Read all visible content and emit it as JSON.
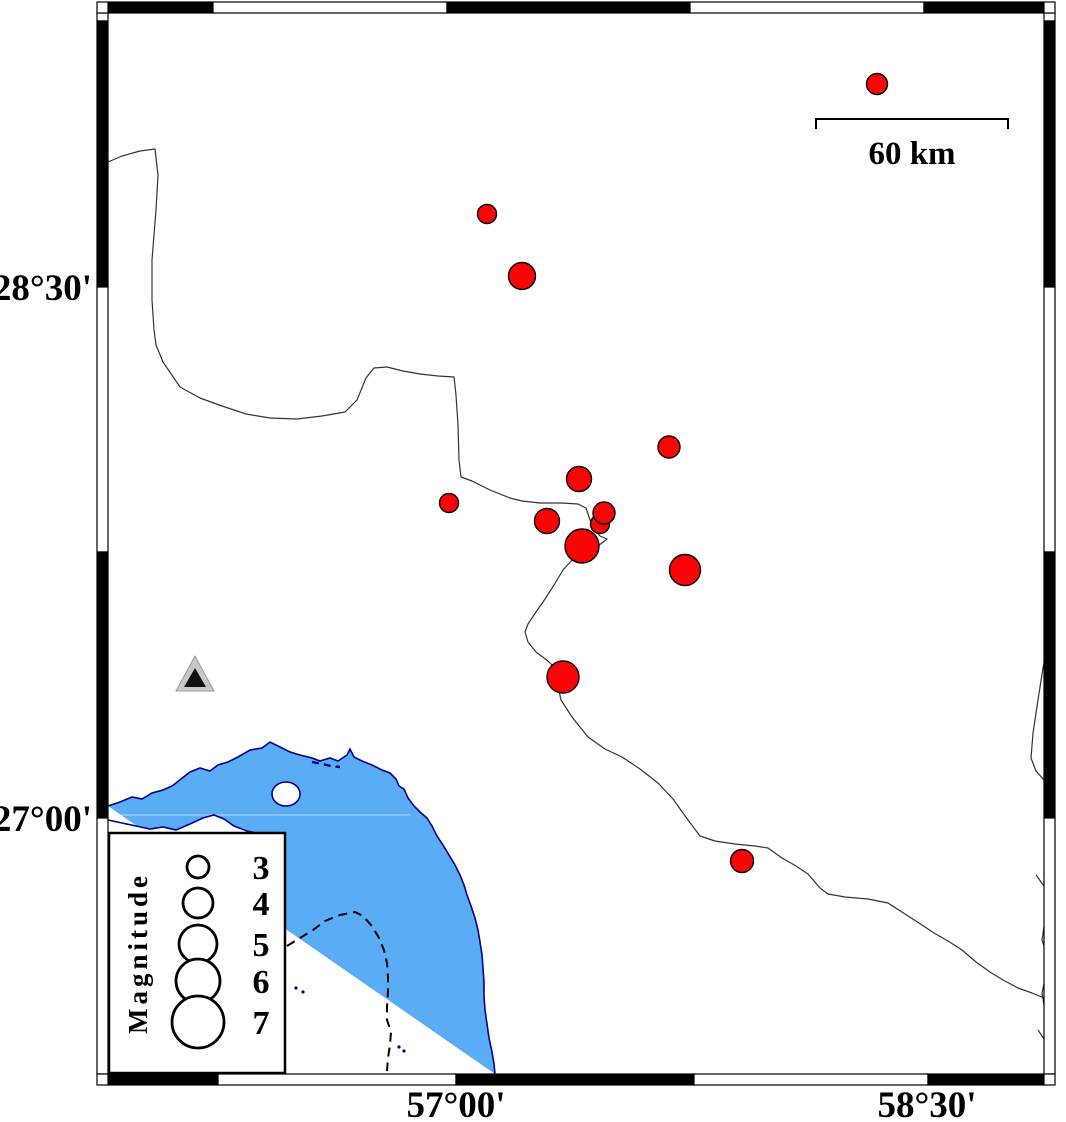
{
  "figure": {
    "type": "seismicity-map",
    "width": 1066,
    "height": 1122,
    "colors": {
      "background": "#ffffff",
      "sea": "#5AACF5",
      "coastline": "#00008C",
      "boundary": "#333333",
      "earthquake_fill": "#FA0505",
      "earthquake_stroke": "#000000",
      "frame_black": "#000000",
      "frame_white": "#ffffff",
      "station_outer": "#C8C8C8",
      "station_inner": "#111111",
      "contour_dash": "#000000"
    },
    "axes": {
      "left_labels": [
        {
          "text": "28°30'",
          "y": 287
        },
        {
          "text": "27°00'",
          "y": 818
        }
      ],
      "bottom_labels": [
        {
          "text": "57°00'",
          "x": 456
        },
        {
          "text": "58°30'",
          "x": 927
        }
      ]
    },
    "frame": {
      "outer": {
        "x": 97,
        "y": 2,
        "w": 969,
        "h": 1083
      },
      "inner": {
        "x1": 108,
        "y1": 13,
        "x2": 1044,
        "y2": 1074
      },
      "band": 11,
      "top_segments": [
        [
          108,
          213,
          "k"
        ],
        [
          213,
          447,
          "w"
        ],
        [
          447,
          690,
          "k"
        ],
        [
          690,
          924,
          "w"
        ],
        [
          924,
          1044,
          "k"
        ]
      ],
      "bottom_segments": [
        [
          108,
          218,
          "k"
        ],
        [
          218,
          456,
          "w"
        ],
        [
          456,
          694,
          "k"
        ],
        [
          694,
          928,
          "w"
        ],
        [
          928,
          1044,
          "k"
        ]
      ],
      "left_segments": [
        [
          13,
          21,
          "w"
        ],
        [
          21,
          287,
          "k"
        ],
        [
          287,
          552,
          "w"
        ],
        [
          552,
          818,
          "k"
        ],
        [
          818,
          1074,
          "w"
        ]
      ],
      "right_segments": [
        [
          13,
          21,
          "w"
        ],
        [
          21,
          287,
          "k"
        ],
        [
          287,
          552,
          "w"
        ],
        [
          552,
          818,
          "k"
        ],
        [
          818,
          1074,
          "w"
        ]
      ]
    },
    "scale_bar": {
      "x1": 816,
      "x2": 1008,
      "y": 119,
      "tick_drop": 10,
      "label": "60 km",
      "label_x": 912,
      "label_y": 164
    },
    "legend": {
      "x": 109,
      "y": 833,
      "w": 176,
      "h": 240,
      "title": "Magnitude",
      "title_x": 147,
      "title_y": 953,
      "circle_x": 198,
      "label_x": 261,
      "entries": [
        {
          "label": "3",
          "r": 11,
          "y": 867
        },
        {
          "label": "4",
          "r": 15,
          "y": 903
        },
        {
          "label": "5",
          "r": 19,
          "y": 944
        },
        {
          "label": "6",
          "r": 22,
          "y": 981
        },
        {
          "label": "7",
          "r": 26,
          "y": 1022
        }
      ]
    },
    "station": {
      "outer": [
        [
          195,
          656
        ],
        [
          176,
          691
        ],
        [
          214,
          691
        ]
      ],
      "inner": [
        [
          195,
          668
        ],
        [
          184,
          687
        ],
        [
          206,
          687
        ]
      ]
    },
    "coast": [
      [
        108,
        806
      ],
      [
        120,
        802
      ],
      [
        132,
        797
      ],
      [
        142,
        799
      ],
      [
        152,
        793
      ],
      [
        163,
        790
      ],
      [
        172,
        786
      ],
      [
        181,
        779
      ],
      [
        190,
        772
      ],
      [
        200,
        768
      ],
      [
        210,
        771
      ],
      [
        218,
        765
      ],
      [
        228,
        762
      ],
      [
        238,
        757
      ],
      [
        250,
        750
      ],
      [
        262,
        748
      ],
      [
        270,
        742
      ],
      [
        280,
        747
      ],
      [
        290,
        752
      ],
      [
        300,
        755
      ],
      [
        312,
        758
      ],
      [
        320,
        761
      ],
      [
        330,
        758
      ],
      [
        338,
        761
      ],
      [
        347,
        755
      ],
      [
        350,
        749
      ],
      [
        354,
        757
      ],
      [
        362,
        761
      ],
      [
        372,
        765
      ],
      [
        382,
        770
      ],
      [
        390,
        773
      ],
      [
        396,
        779
      ],
      [
        399,
        786
      ],
      [
        404,
        789
      ],
      [
        408,
        798
      ],
      [
        414,
        806
      ],
      [
        420,
        812
      ],
      [
        427,
        818
      ],
      [
        432,
        826
      ],
      [
        437,
        836
      ],
      [
        443,
        845
      ],
      [
        449,
        855
      ],
      [
        455,
        865
      ],
      [
        460,
        875
      ],
      [
        464,
        885
      ],
      [
        467,
        895
      ],
      [
        471,
        906
      ],
      [
        475,
        918
      ],
      [
        478,
        930
      ],
      [
        480,
        942
      ],
      [
        482,
        955
      ],
      [
        483,
        968
      ],
      [
        484,
        982
      ],
      [
        484,
        996
      ],
      [
        485,
        1010
      ],
      [
        487,
        1024
      ],
      [
        489,
        1038
      ],
      [
        492,
        1052
      ],
      [
        494,
        1064
      ],
      [
        495,
        1074
      ]
    ],
    "south_shore": [
      [
        108,
        820
      ],
      [
        122,
        823
      ],
      [
        136,
        826
      ],
      [
        150,
        829
      ],
      [
        163,
        827
      ],
      [
        176,
        830
      ],
      [
        190,
        824
      ],
      [
        203,
        818
      ],
      [
        214,
        815
      ],
      [
        224,
        819
      ],
      [
        234,
        826
      ],
      [
        247,
        831
      ],
      [
        260,
        834
      ],
      [
        272,
        837
      ],
      [
        283,
        841
      ],
      [
        283,
        858
      ],
      [
        108,
        858
      ]
    ],
    "south_shore_line_points": 15,
    "island": {
      "cx": 286,
      "cy": 794,
      "rx": 14,
      "ry": 12
    },
    "islets": [
      [
        296,
        988
      ],
      [
        303,
        992
      ],
      [
        399,
        1047
      ],
      [
        404,
        1051
      ]
    ],
    "shore_dashes": [
      [
        312,
        762
      ],
      [
        322,
        764
      ],
      [
        331,
        766
      ],
      [
        340,
        767
      ]
    ],
    "sea_gridline": {
      "y": 815,
      "x1": 108,
      "x2": 410
    },
    "boundaries": [
      [
        [
          108,
          162
        ],
        [
          122,
          156
        ],
        [
          140,
          151
        ],
        [
          155,
          149
        ],
        [
          158,
          175
        ],
        [
          156,
          210
        ],
        [
          152,
          260
        ],
        [
          152,
          300
        ],
        [
          154,
          330
        ],
        [
          156,
          345
        ],
        [
          163,
          362
        ],
        [
          180,
          387
        ],
        [
          200,
          398
        ],
        [
          222,
          406
        ],
        [
          246,
          414
        ],
        [
          270,
          418
        ],
        [
          297,
          419
        ],
        [
          322,
          416
        ],
        [
          345,
          412
        ],
        [
          357,
          400
        ],
        [
          366,
          378
        ],
        [
          374,
          368
        ],
        [
          387,
          367
        ],
        [
          403,
          371
        ],
        [
          420,
          374
        ],
        [
          438,
          376
        ],
        [
          454,
          377
        ],
        [
          456,
          395
        ],
        [
          458,
          425
        ],
        [
          459,
          460
        ],
        [
          461,
          477
        ],
        [
          472,
          481
        ],
        [
          490,
          490
        ],
        [
          510,
          498
        ],
        [
          522,
          501
        ],
        [
          540,
          503
        ],
        [
          562,
          503
        ],
        [
          578,
          504
        ],
        [
          586,
          508
        ],
        [
          589,
          517
        ],
        [
          593,
          528
        ],
        [
          600,
          536
        ],
        [
          607,
          539
        ],
        [
          598,
          546
        ],
        [
          584,
          552
        ],
        [
          573,
          559
        ],
        [
          563,
          570
        ],
        [
          554,
          585
        ],
        [
          545,
          599
        ],
        [
          536,
          612
        ],
        [
          528,
          624
        ],
        [
          525,
          632
        ],
        [
          528,
          642
        ],
        [
          536,
          652
        ],
        [
          548,
          661
        ],
        [
          556,
          669
        ],
        [
          558,
          686
        ],
        [
          561,
          700
        ],
        [
          572,
          717
        ],
        [
          588,
          737
        ],
        [
          605,
          749
        ],
        [
          622,
          757
        ],
        [
          640,
          769
        ],
        [
          658,
          783
        ],
        [
          673,
          799
        ],
        [
          688,
          820
        ],
        [
          700,
          836
        ],
        [
          715,
          841
        ],
        [
          735,
          844
        ],
        [
          755,
          846
        ],
        [
          768,
          848
        ],
        [
          782,
          858
        ],
        [
          796,
          866
        ],
        [
          808,
          874
        ],
        [
          820,
          888
        ],
        [
          828,
          894
        ],
        [
          845,
          897
        ],
        [
          868,
          899
        ],
        [
          888,
          903
        ],
        [
          905,
          914
        ],
        [
          922,
          925
        ],
        [
          934,
          933
        ],
        [
          948,
          941
        ],
        [
          962,
          950
        ],
        [
          976,
          962
        ],
        [
          990,
          972
        ],
        [
          1003,
          980
        ],
        [
          1018,
          988
        ],
        [
          1032,
          993
        ],
        [
          1044,
          998
        ]
      ],
      [
        [
          1044,
          489
        ],
        [
          1050,
          495
        ],
        [
          1047,
          505
        ],
        [
          1051,
          514
        ],
        [
          1044,
          520
        ]
      ],
      [
        [
          1055,
          612
        ],
        [
          1048,
          640
        ],
        [
          1043,
          668
        ],
        [
          1038,
          700
        ],
        [
          1033,
          733
        ],
        [
          1031,
          758
        ],
        [
          1036,
          771
        ],
        [
          1044,
          780
        ],
        [
          1050,
          790
        ],
        [
          1055,
          797
        ]
      ],
      [
        [
          1036,
          875
        ],
        [
          1044,
          886
        ],
        [
          1050,
          900
        ],
        [
          1045,
          920
        ],
        [
          1042,
          940
        ],
        [
          1048,
          958
        ],
        [
          1046,
          975
        ],
        [
          1042,
          993
        ],
        [
          1044,
          1005
        ]
      ],
      [
        [
          1038,
          1030
        ],
        [
          1046,
          1042
        ],
        [
          1052,
          1052
        ],
        [
          1055,
          1058
        ]
      ]
    ],
    "bathy_contour": [
      [
        287,
        946
      ],
      [
        300,
        938
      ],
      [
        313,
        930
      ],
      [
        325,
        921
      ],
      [
        340,
        915
      ],
      [
        355,
        912
      ],
      [
        363,
        916
      ],
      [
        371,
        925
      ],
      [
        378,
        936
      ],
      [
        384,
        950
      ],
      [
        387,
        963
      ],
      [
        388,
        977
      ],
      [
        388,
        992
      ],
      [
        387,
        1007
      ],
      [
        387,
        1020
      ],
      [
        391,
        1032
      ],
      [
        390,
        1045
      ],
      [
        388,
        1058
      ],
      [
        387,
        1071
      ]
    ]
  },
  "chart_data": {
    "type": "scatter",
    "title": "",
    "x_axis_labels": [
      "57°00'",
      "58°30'"
    ],
    "y_axis_labels": [
      "28°30'",
      "27°00'"
    ],
    "scale_bar_label": "60 km",
    "legend_title": "Magnitude",
    "legend_magnitudes": [
      3,
      4,
      5,
      6,
      7
    ],
    "earthquakes": [
      {
        "x": 877,
        "y": 84,
        "r": 10.5,
        "mag_est": 2.9,
        "lon": 58.34,
        "lat": 29.07
      },
      {
        "x": 487,
        "y": 214,
        "r": 9.5,
        "mag_est": 2.6,
        "lon": 57.09,
        "lat": 28.71
      },
      {
        "x": 522,
        "y": 276,
        "r": 13.5,
        "mag_est": 3.7,
        "lon": 57.2,
        "lat": 28.53
      },
      {
        "x": 669,
        "y": 447,
        "r": 11,
        "mag_est": 3.0,
        "lon": 57.67,
        "lat": 28.05
      },
      {
        "x": 579,
        "y": 479,
        "r": 12.5,
        "mag_est": 3.4,
        "lon": 57.38,
        "lat": 27.96
      },
      {
        "x": 449,
        "y": 503,
        "r": 9.5,
        "mag_est": 2.6,
        "lon": 56.96,
        "lat": 27.89
      },
      {
        "x": 600,
        "y": 524,
        "r": 9.5,
        "mag_est": 2.6,
        "lon": 57.45,
        "lat": 27.83
      },
      {
        "x": 604,
        "y": 513,
        "r": 11,
        "mag_est": 3.0,
        "lon": 57.46,
        "lat": 27.86
      },
      {
        "x": 547,
        "y": 521,
        "r": 12.5,
        "mag_est": 3.4,
        "lon": 57.28,
        "lat": 27.84
      },
      {
        "x": 582,
        "y": 546,
        "r": 17,
        "mag_est": 4.6,
        "lon": 57.39,
        "lat": 27.77
      },
      {
        "x": 685,
        "y": 570,
        "r": 15.5,
        "mag_est": 4.1,
        "lon": 57.72,
        "lat": 27.7
      },
      {
        "x": 563,
        "y": 677,
        "r": 16,
        "mag_est": 4.3,
        "lon": 57.33,
        "lat": 27.4
      },
      {
        "x": 742,
        "y": 861,
        "r": 11.5,
        "mag_est": 3.1,
        "lon": 57.9,
        "lat": 26.88
      }
    ],
    "station": {
      "lon": 56.15,
      "lat": 27.41
    }
  }
}
